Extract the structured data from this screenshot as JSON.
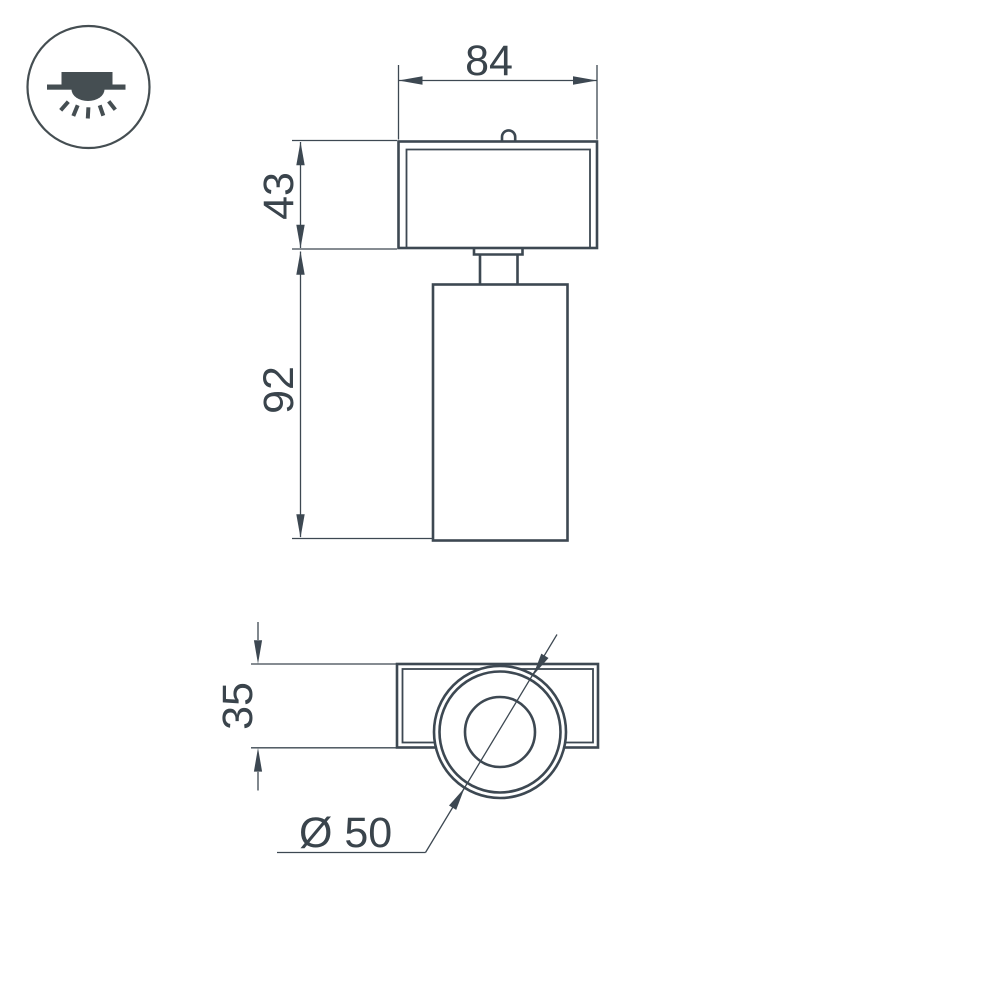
{
  "icon": {
    "name": "recessed-downlight-icon"
  },
  "drawing": {
    "dim_width": "84",
    "dim_box_height": "43",
    "dim_body_height": "92",
    "dim_side_height": "35",
    "dim_diameter": "Ø 50"
  },
  "colors": {
    "line": "#3d4852",
    "text": "#3a444c",
    "icon": "#454e52",
    "background": "#ffffff"
  }
}
